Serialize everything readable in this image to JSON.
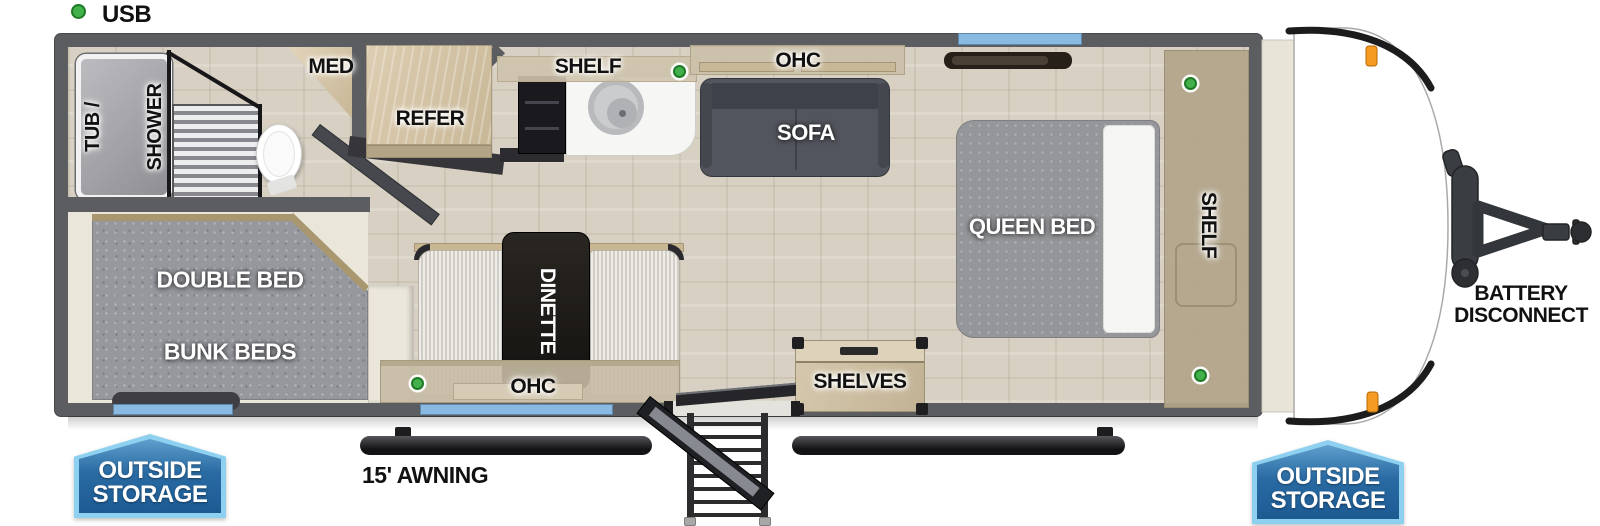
{
  "legend": {
    "usb": "USB"
  },
  "labels": {
    "tub_shower_line1": "TUB /",
    "tub_shower_line2": "SHOWER",
    "med": "MED",
    "refer": "REFER",
    "kitchen_shelf": "SHELF",
    "ohc_top": "OHC",
    "sofa": "SOFA",
    "queen_bed": "QUEEN BED",
    "wall_shelf": "SHELF",
    "bunk_line1": "DOUBLE BED",
    "bunk_line2": "BUNK BEDS",
    "dinette": "DINETTE",
    "ohc_bottom": "OHC",
    "shelves": "SHELVES",
    "awning": "15' AWNING",
    "battery_line1": "BATTERY",
    "battery_line2": "DISCONNECT",
    "outside_storage_line1": "OUTSIDE",
    "outside_storage_line2": "STORAGE"
  },
  "icons": {
    "usb_port": "green-circle-marker"
  },
  "counts": {
    "usb_ports_in_plan": 4,
    "outside_storage_badges": 2
  },
  "colors": {
    "wall": "#5b5d60",
    "wall_dark": "#47484b",
    "floor": "#d8d1c3",
    "carpet": "#96989e",
    "sofa": "#52555d",
    "sofa_dark": "#3e4149",
    "bed_gray": "#95969a",
    "pillow": "#f5f5f3",
    "bench": "#dcd8cf",
    "counter_white": "#f6f6f4",
    "stove_black": "#1a1a1e",
    "window_blue": "#8ab9e2",
    "usb_green": "#43b14b",
    "usb_green_dark": "#1f7a26",
    "badge_border": "#8ed0ef",
    "badge_bottom": "#1c5a92",
    "awning": "#1d1d20",
    "text_black": "#111111",
    "text_white": "#ffffff"
  }
}
